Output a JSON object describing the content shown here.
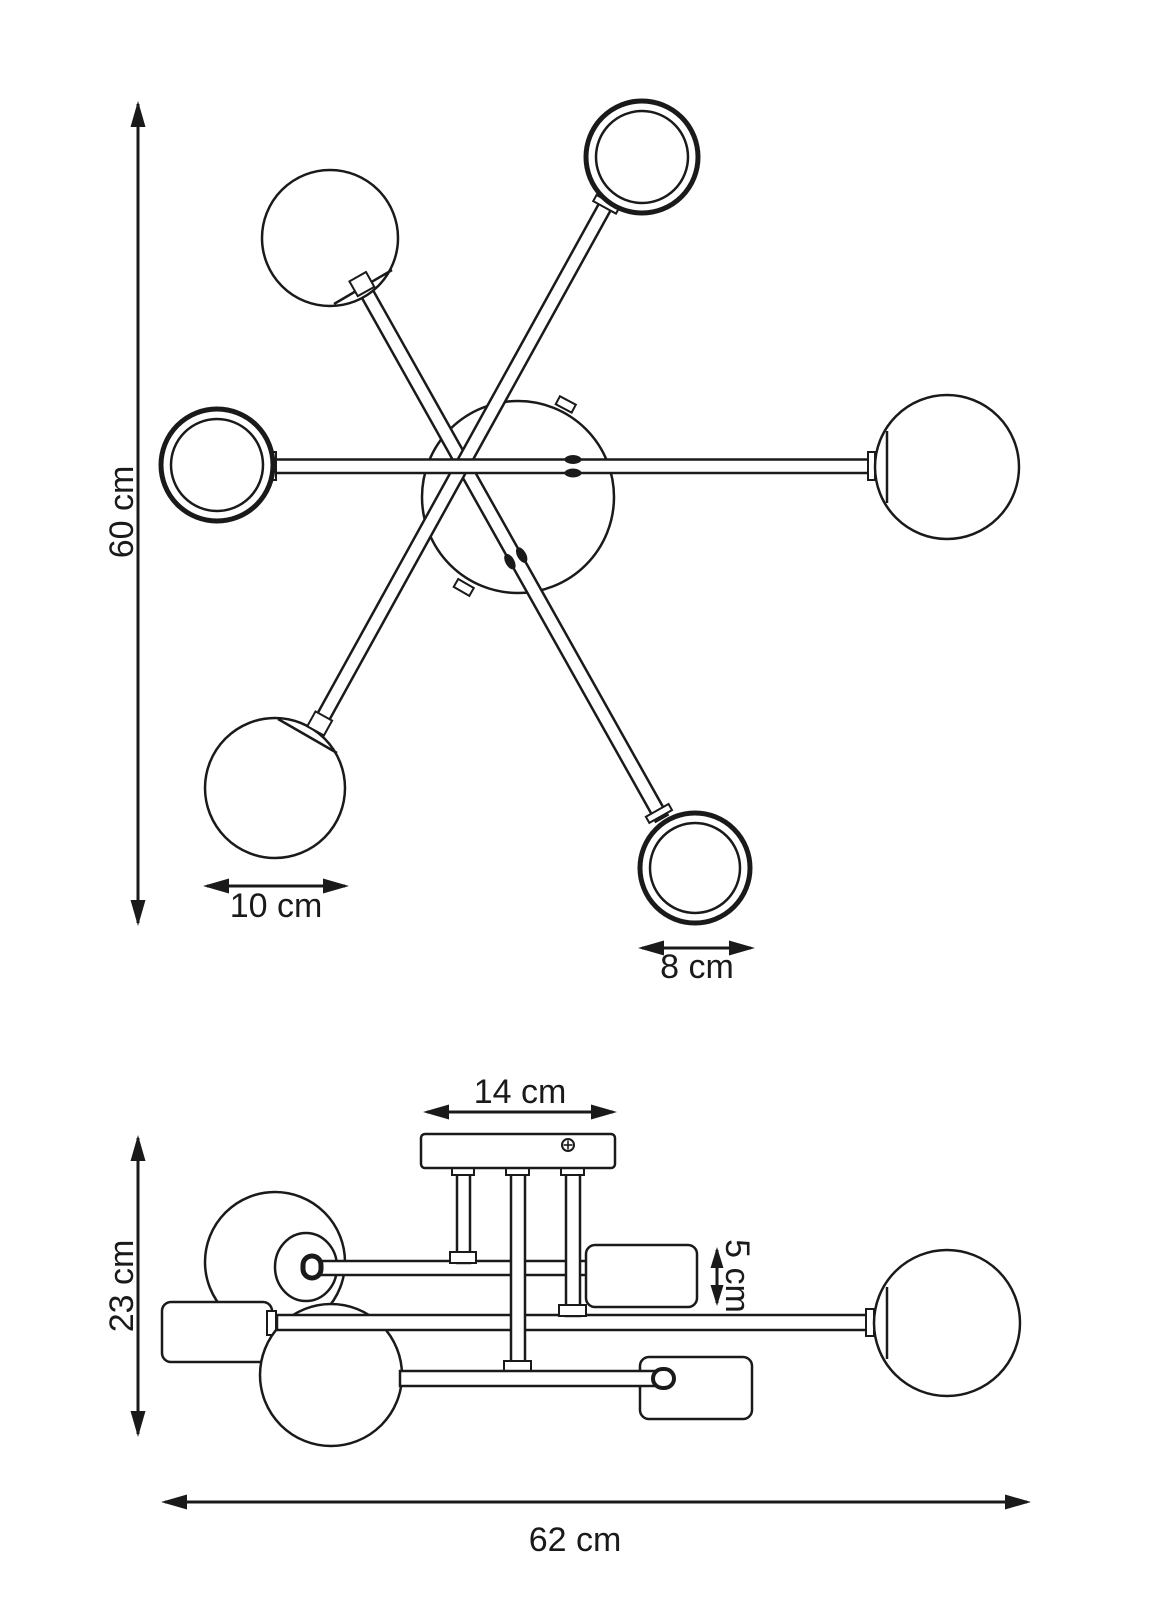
{
  "diagram": {
    "background": "#ffffff",
    "line_color": "#1a1a1a",
    "description": "technical dimension drawing of a 6-arm ceiling lamp, top view and side view",
    "top_view": {
      "dim_height_label": "60 cm",
      "dim_sphere_diameter_label": "10 cm",
      "dim_ring_diameter_label": "8 cm"
    },
    "side_view": {
      "dim_canopy_width_label": "14 cm",
      "dim_shade_height_label": "5 cm",
      "dim_total_height_label": "23 cm",
      "dim_total_width_label": "62 cm"
    }
  }
}
